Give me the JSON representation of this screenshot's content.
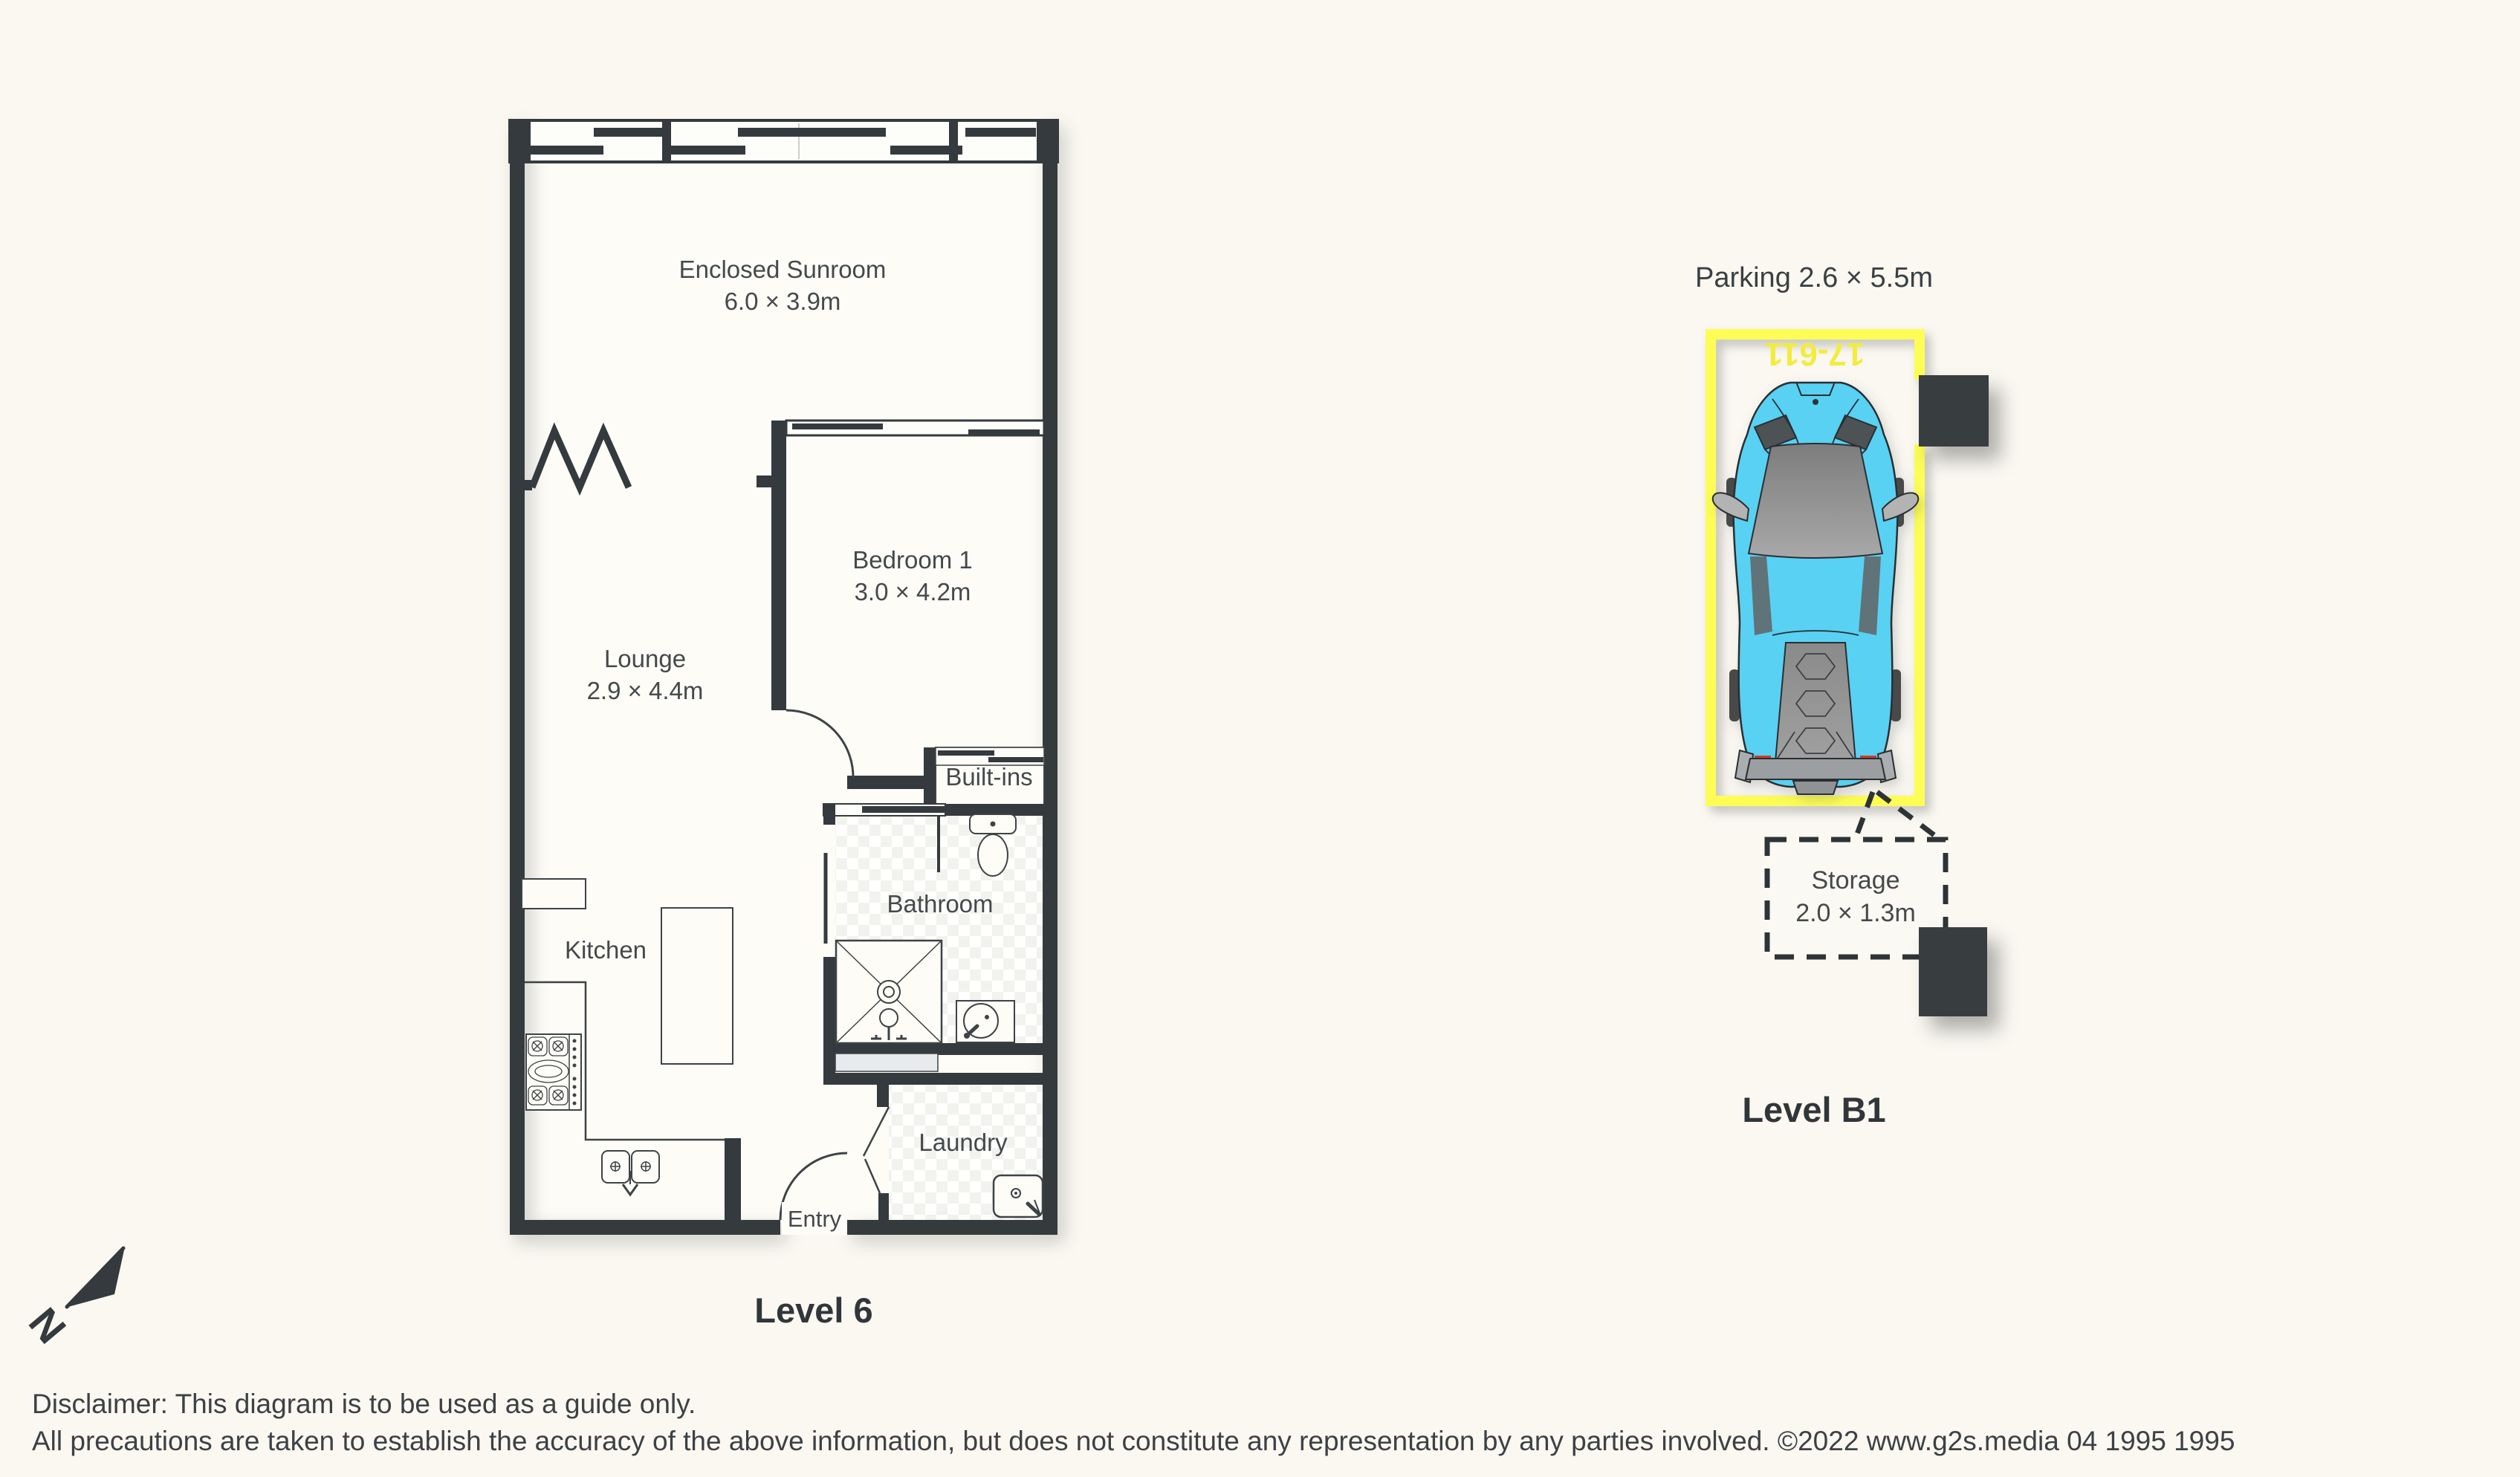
{
  "floorplan": {
    "level_label": "Level 6",
    "rooms": {
      "sunroom": {
        "name": "Enclosed Sunroom",
        "dims": "6.0 × 3.9m"
      },
      "bedroom": {
        "name": "Bedroom 1",
        "dims": "3.0 × 4.2m"
      },
      "lounge": {
        "name": "Lounge",
        "dims": "2.9 × 4.4m"
      },
      "kitchen": {
        "name": "Kitchen"
      },
      "bathroom": {
        "name": "Bathroom"
      },
      "laundry": {
        "name": "Laundry"
      },
      "builtins": {
        "name": "Built-ins"
      },
      "entry": {
        "name": "Entry"
      }
    }
  },
  "parking": {
    "title": "Parking 2.6 × 5.5m",
    "bay_number": "17-611",
    "level_label": "Level B1",
    "storage": {
      "name": "Storage",
      "dims": "2.0 × 1.3m"
    }
  },
  "compass": {
    "north_label": "N"
  },
  "footer": {
    "line1": "Disclaimer: This diagram is to be used as a guide only.",
    "line2": "All precautions are taken to establish the accuracy of the above information, but does not constitute any representation by any parties involved. ©2022 www.g2s.media 04 1995 1995"
  },
  "colors": {
    "wall": "#343a3d",
    "text": "#45494c",
    "page_background": "#faf8f1",
    "floor": "#fdfcf7",
    "tile": "#f0f0ec",
    "bay_yellow": "#fdfd57",
    "car_cyan": "#58d1f3",
    "column": "#383d40",
    "niche": "#e7ebee"
  }
}
